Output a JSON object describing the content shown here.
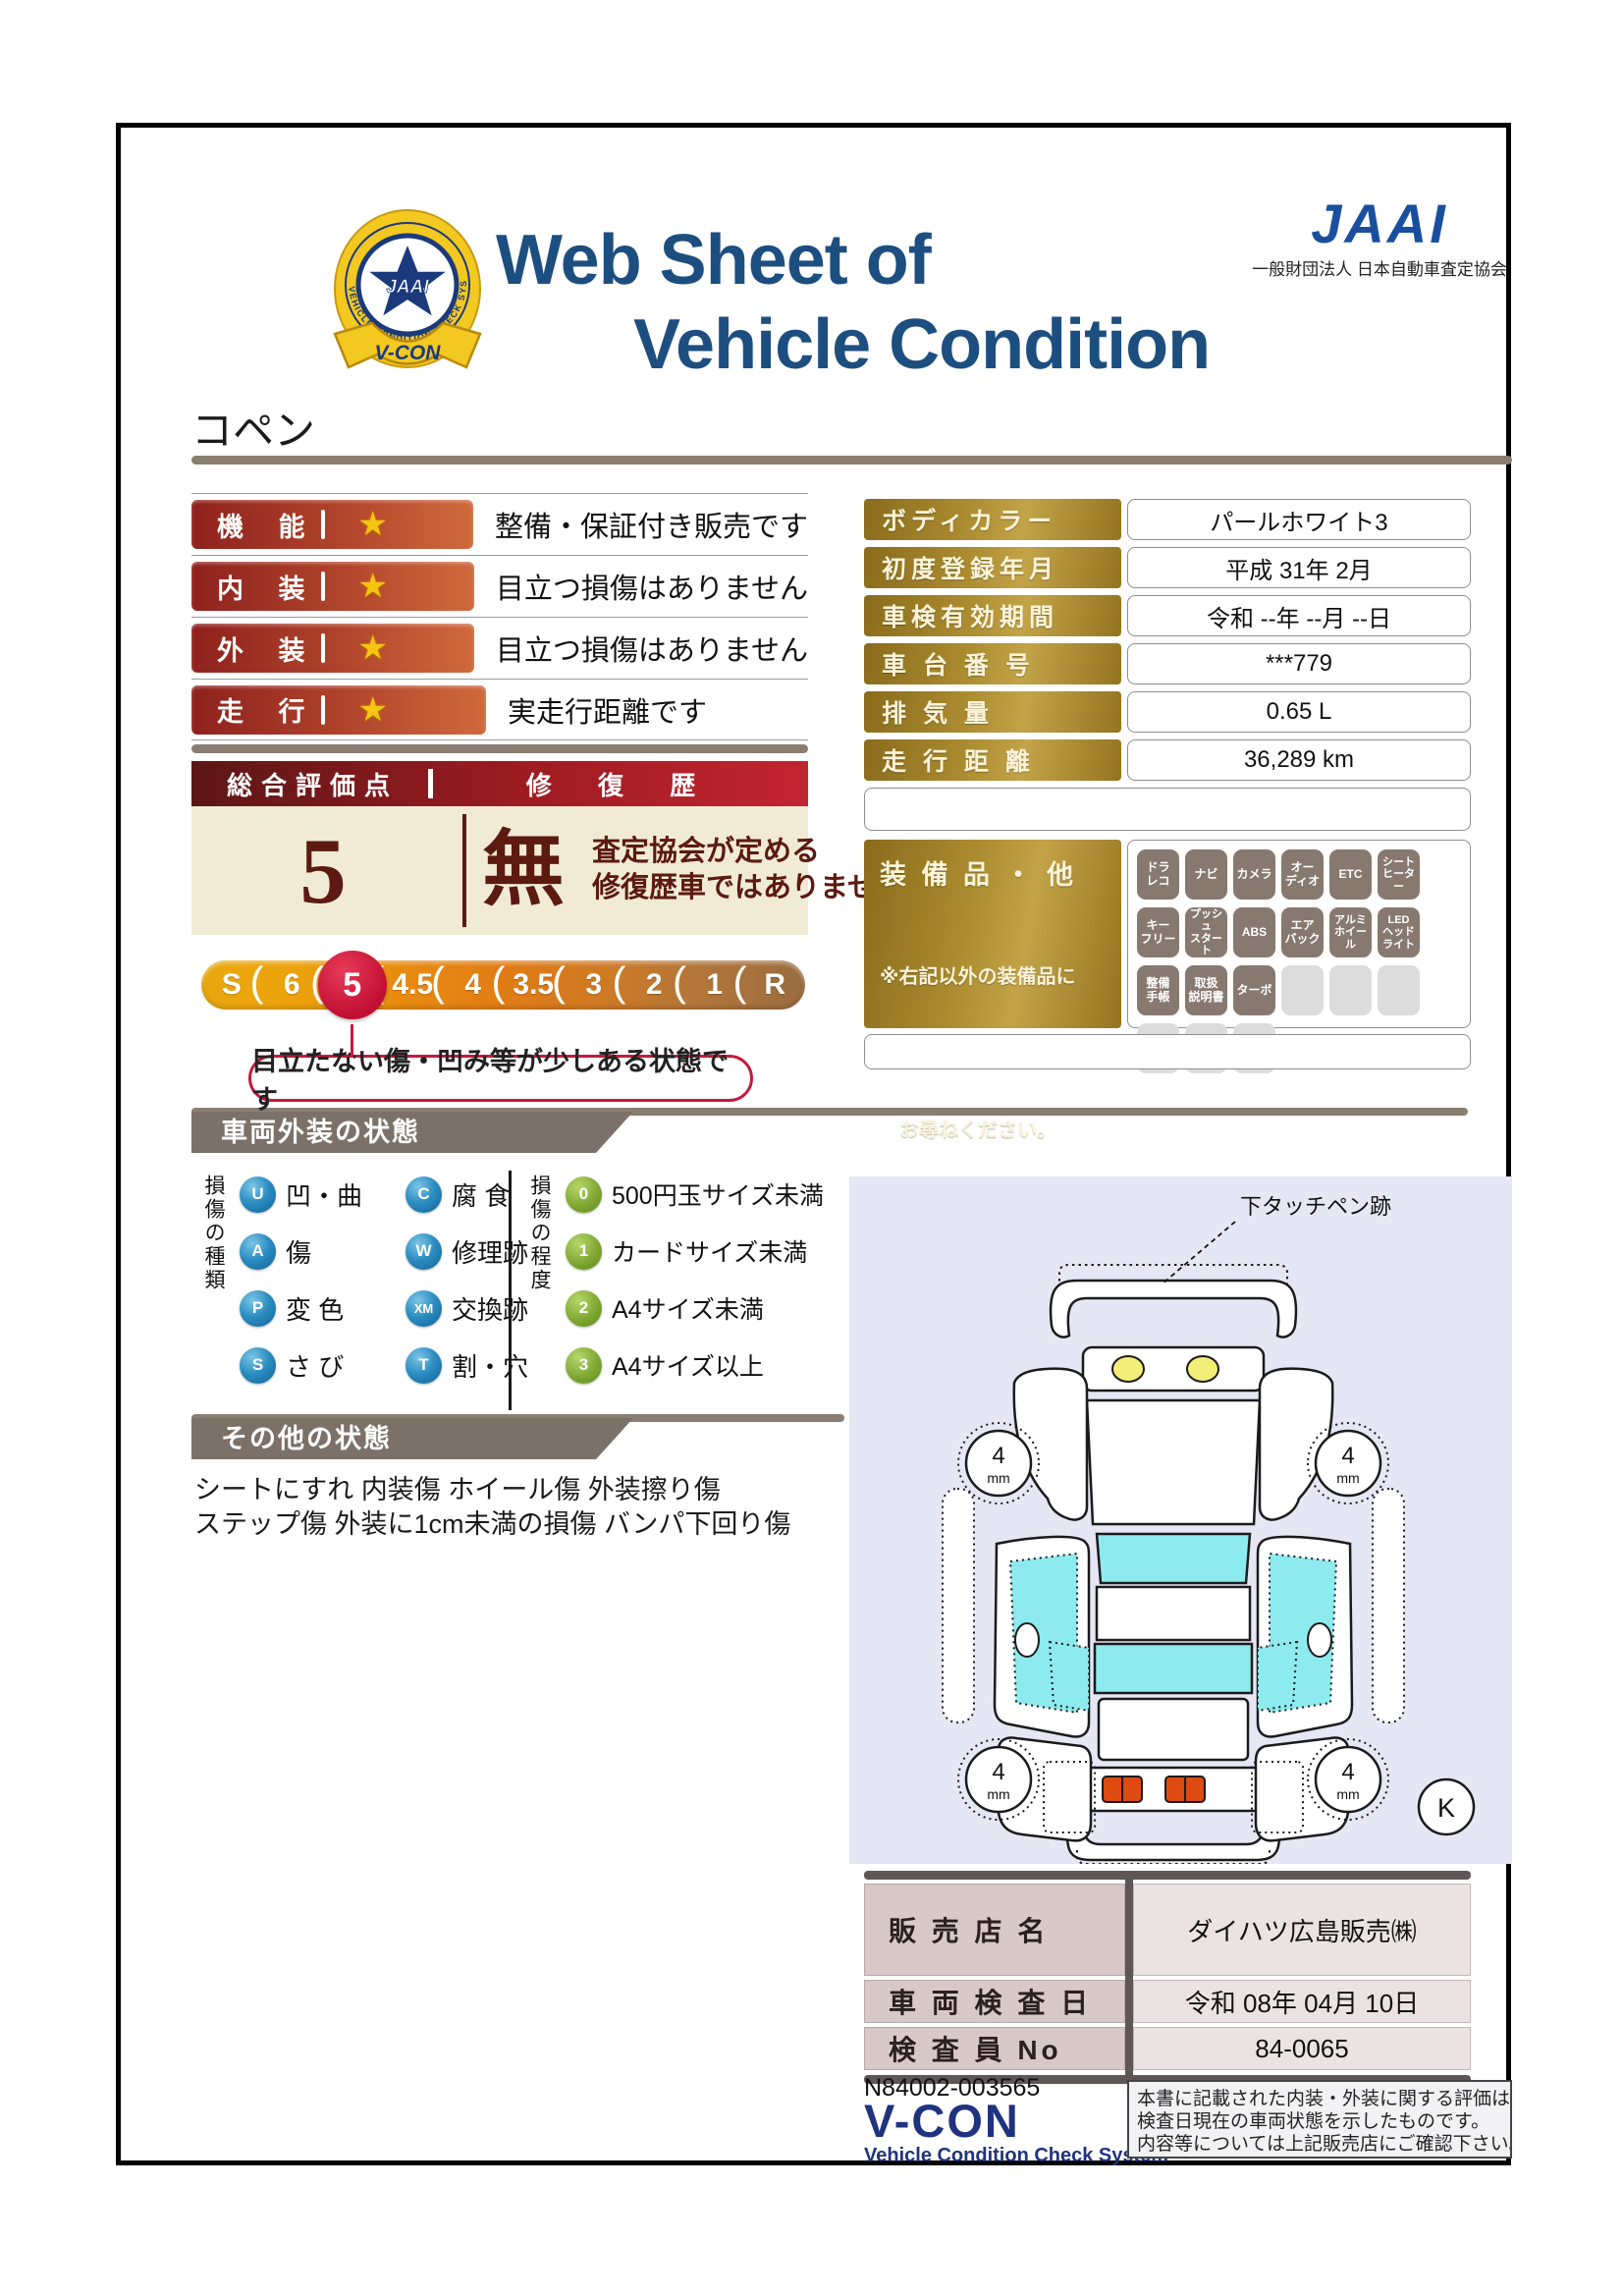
{
  "emblem": {
    "ring_text": "VEHICLE CONDITION CHECK SYSTEM",
    "star_text": "JAAI",
    "ribbon_text": "V-CON"
  },
  "header": {
    "title_line1": "Web Sheet of",
    "title_line2": "Vehicle Condition",
    "jaai_wordmark": "JAAI",
    "jaai_org": "一般財団法人 日本自動車査定協会"
  },
  "vehicle_name": "コペン",
  "ratings": [
    {
      "label": "機  能",
      "star": "★",
      "desc": "整備・保証付き販売です"
    },
    {
      "label": "内  装",
      "star": "★",
      "desc": "目立つ損傷はありません"
    },
    {
      "label": "外  装",
      "star": "★",
      "desc": "目立つ損傷はありません"
    },
    {
      "label": "走  行",
      "star": "★",
      "desc": "実走行距離です"
    }
  ],
  "info_table": {
    "rows": [
      {
        "label": "ボディカラー",
        "value": "パールホワイト3"
      },
      {
        "label": "初度登録年月",
        "value": "平成 31年 2月"
      },
      {
        "label": "車検有効期間",
        "value": "令和 --年 --月 --日"
      },
      {
        "label": "車 台 番 号",
        "value": "***779"
      },
      {
        "label": "排  気  量",
        "value": "0.65 L"
      },
      {
        "label": "走 行 距 離",
        "value": "36,289 km"
      }
    ]
  },
  "overall": {
    "header_left": "総合評価点",
    "header_right": "修 復 歴",
    "score": "5",
    "repair_status": "無",
    "repair_note_line1": "査定協会が定める",
    "repair_note_line2": "修復歴車ではありません"
  },
  "scale": {
    "items": [
      "S",
      "6",
      "5",
      "4.5",
      "4",
      "3.5",
      "3",
      "2",
      "1",
      "R"
    ],
    "selected": "5",
    "callout": "目立たない傷・凹み等が少しある状態です"
  },
  "equipment": {
    "title": "装 備 品 ・ 他",
    "note_line1": "※右記以外の装備品に",
    "note_line2": "　ついてはスタッフに",
    "note_line3": "　お尋ねください。",
    "badges": [
      "ドラ\nレコ",
      "ナビ",
      "カメラ",
      "オー\nディオ",
      "ETC",
      "シート\nヒーター",
      "キー\nフリー",
      "プッシュ\nスタート",
      "ABS",
      "エア\nバック",
      "アルミ\nホイール",
      "LED\nヘッド\nライト",
      "整備\n手帳",
      "取扱\n説明書",
      "ターボ"
    ]
  },
  "exterior": {
    "title": "車両外装の状態",
    "type_axis": "損傷の種類",
    "types": [
      {
        "code": "U",
        "label": "凹・曲"
      },
      {
        "code": "C",
        "label": "腐 食"
      },
      {
        "code": "A",
        "label": "傷"
      },
      {
        "code": "W",
        "label": "修理跡"
      },
      {
        "code": "P",
        "label": "変 色"
      },
      {
        "code": "XM",
        "label": "交換跡"
      },
      {
        "code": "S",
        "label": "さ び"
      },
      {
        "code": "T",
        "label": "割・穴"
      }
    ],
    "degree_axis": "損傷の程度",
    "degrees": [
      {
        "code": "0",
        "label": "500円玉サイズ未満"
      },
      {
        "code": "1",
        "label": "カードサイズ未満"
      },
      {
        "code": "2",
        "label": "A4サイズ未満"
      },
      {
        "code": "3",
        "label": "A4サイズ以上"
      }
    ]
  },
  "other": {
    "title": "その他の状態",
    "line1": "シートにすれ 内装傷 ホイール傷 外装擦り傷",
    "line2": "ステップ傷 外装に1cm未満の損傷 バンパ下回り傷"
  },
  "diagram": {
    "annotation": "下タッチペン跡",
    "tire_value": "4",
    "tire_unit": "mm",
    "corner_mark": "K"
  },
  "dealer": {
    "rows": [
      {
        "label": "販 売 店 名",
        "value": "ダイハツ広島販売㈱"
      },
      {
        "label": "車 両 検 査 日",
        "value": "令和 08年 04月 10日"
      },
      {
        "label": "検 査 員 No",
        "value": "84-0065"
      }
    ]
  },
  "footer": {
    "serial": "N84002-003565",
    "vcon": "V-CON",
    "vcon_sub": "Vehicle Condition Check System",
    "disclaimer_line1": "本書に記載された内装・外装に関する評価は、車両",
    "disclaimer_line2": "検査日現在の車両状態を示したものです。",
    "disclaimer_line3": "内容等については上記販売店にご確認下さい。"
  }
}
